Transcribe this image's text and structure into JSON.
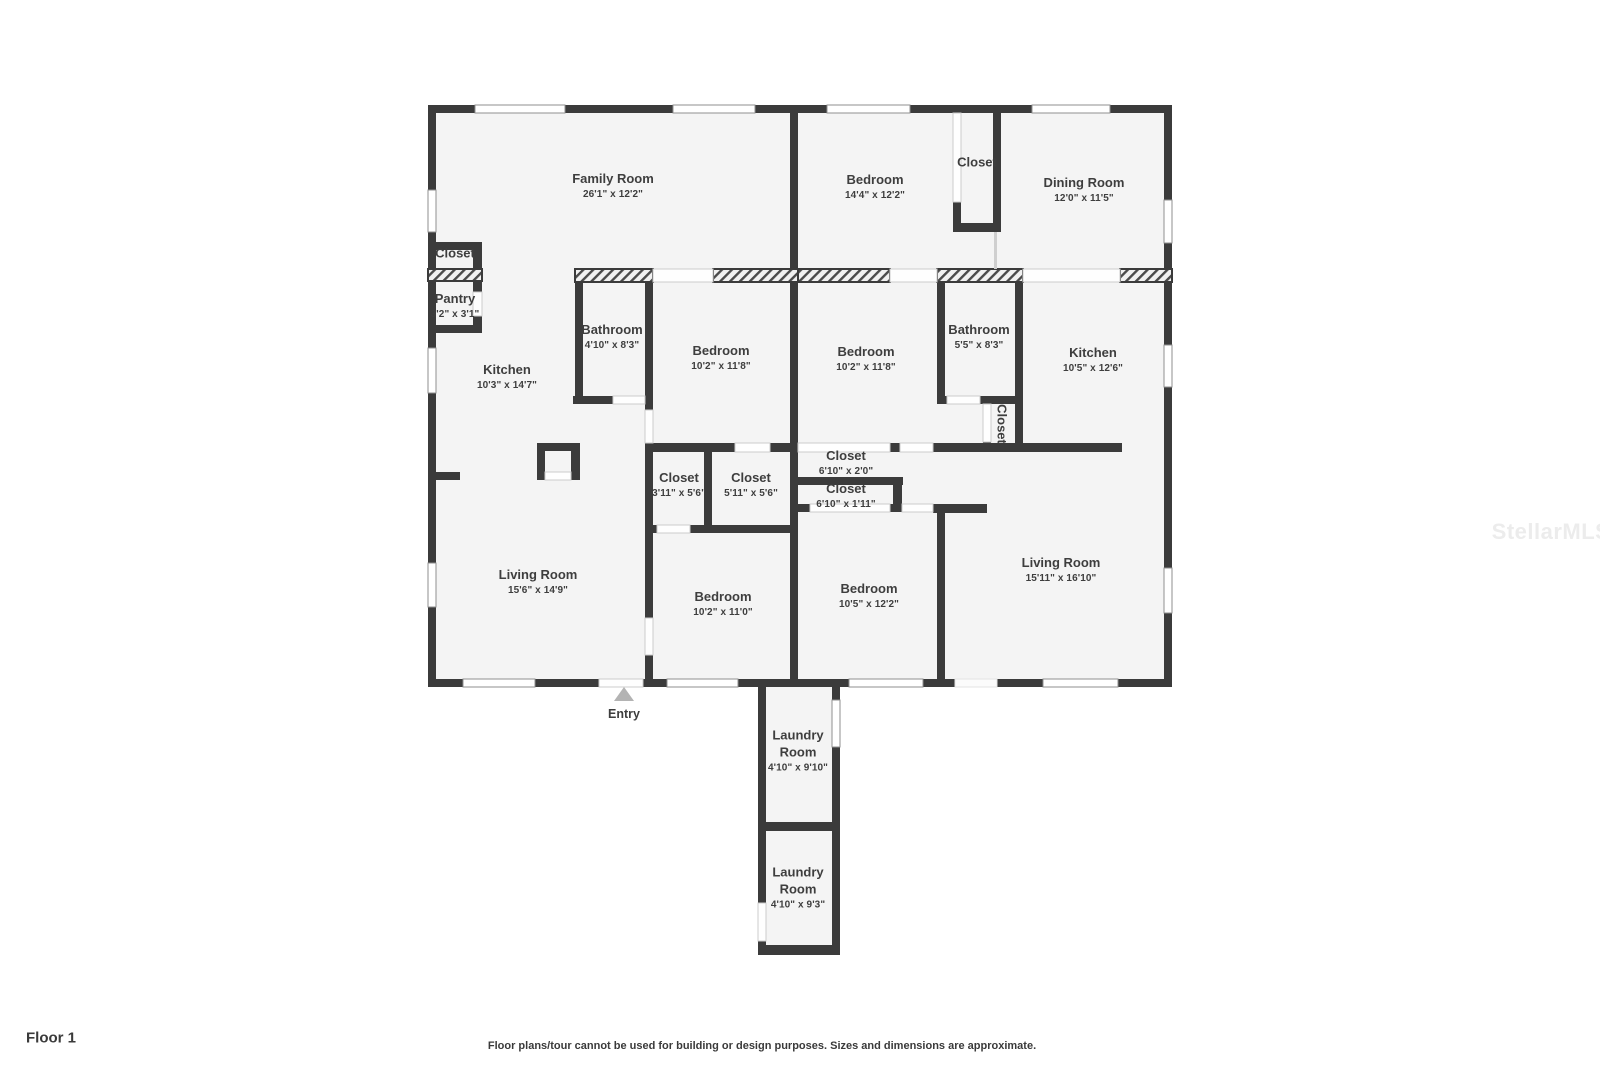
{
  "page": {
    "floor_label": "Floor 1",
    "disclaimer": "Floor plans/tour cannot be used for building or design purposes. Sizes and dimensions are approximate.",
    "watermark": "StellarMLS",
    "entry_label": "Entry",
    "colors": {
      "wall": "#3b3b3b",
      "floor": "#f4f4f4",
      "text": "#3e3e3e",
      "entry_arrow": "#b3b3b3",
      "watermark": "#ececec"
    }
  },
  "rooms": {
    "family_room": {
      "name": "Family Room",
      "dims": "26'1\" x 12'2\""
    },
    "bedroom_top_right": {
      "name": "Bedroom",
      "dims": "14'4\" x 12'2\""
    },
    "closet_top_right": {
      "name": "Closet"
    },
    "dining_room": {
      "name": "Dining Room",
      "dims": "12'0\" x 11'5\""
    },
    "closet_left": {
      "name": "Closet"
    },
    "pantry": {
      "name": "Pantry",
      "dims": "3'2\" x 3'1\""
    },
    "kitchen_left": {
      "name": "Kitchen",
      "dims": "10'3\" x 14'7\""
    },
    "bathroom_left": {
      "name": "Bathroom",
      "dims": "4'10\" x 8'3\""
    },
    "bedroom_mid_left": {
      "name": "Bedroom",
      "dims": "10'2\" x 11'8\""
    },
    "bedroom_mid_right": {
      "name": "Bedroom",
      "dims": "10'2\" x 11'8\""
    },
    "bathroom_right": {
      "name": "Bathroom",
      "dims": "5'5\" x 8'3\""
    },
    "kitchen_right": {
      "name": "Kitchen",
      "dims": "10'5\" x 12'6\""
    },
    "closet_hall_right": {
      "name": "Closet"
    },
    "closet_small_left": {
      "name": "Closet",
      "dims": "3'11\" x 5'6\""
    },
    "closet_small_mid": {
      "name": "Closet",
      "dims": "5'11\" x 5'6\""
    },
    "closet_wide_upper": {
      "name": "Closet",
      "dims": "6'10\" x 2'0\""
    },
    "closet_wide_lower": {
      "name": "Closet",
      "dims": "6'10\" x 1'11\""
    },
    "living_room_left": {
      "name": "Living Room",
      "dims": "15'6\" x 14'9\""
    },
    "bedroom_bottom_left": {
      "name": "Bedroom",
      "dims": "10'2\" x 11'0\""
    },
    "bedroom_bottom_right": {
      "name": "Bedroom",
      "dims": "10'5\" x 12'2\""
    },
    "living_room_right": {
      "name": "Living Room",
      "dims": "15'11\" x 16'10\""
    },
    "laundry_room_top": {
      "name": "Laundry Room",
      "dims": "4'10\" x 9'10\""
    },
    "laundry_room_bottom": {
      "name": "Laundry Room",
      "dims": "4'10\" x 9'3\""
    }
  }
}
